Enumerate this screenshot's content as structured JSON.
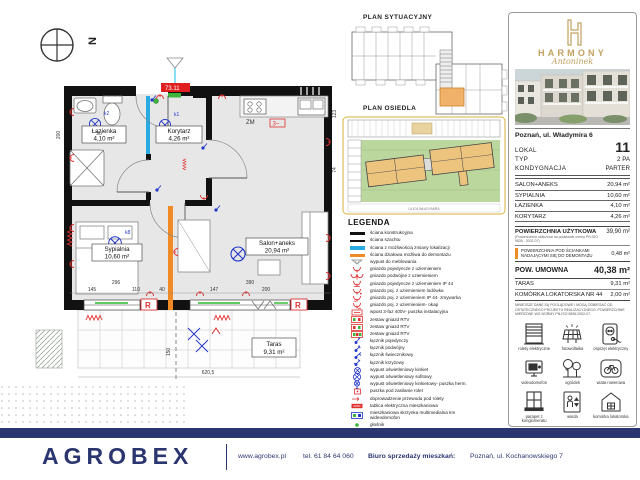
{
  "floorplan": {
    "north": "N",
    "entrance_no": "73.11",
    "zm": "ZM",
    "phase": "3~",
    "r_label": "R",
    "rooms": [
      {
        "name": "Łazienka",
        "area": "4,10 m²"
      },
      {
        "name": "Korytarz",
        "area": "4,26 m²"
      },
      {
        "name": "Sypialnia",
        "area": "10,60 m²"
      },
      {
        "name": "Salon+aneks",
        "area": "20,94 m²"
      },
      {
        "name": "Taras",
        "area": "9,31 m²"
      }
    ],
    "lights": [
      "k1",
      "k2",
      "k7",
      "k8"
    ],
    "dims": {
      "d1": "200",
      "d2": "90",
      "d3": "296",
      "d4": "390",
      "d5": "145",
      "d6": "110",
      "d7": "40",
      "d8": "147",
      "d9": "200",
      "d10": "620,5",
      "d11": "150",
      "d12": "74",
      "d13": "123"
    }
  },
  "plans": {
    "situational_title": "PLAN SYTUACYJNY",
    "estate_title": "PLAN OSIEDLA",
    "street_label": "ULICA WŁADYMIRA"
  },
  "legend": {
    "title": "LEGENDA",
    "items": [
      "ściana konstrukcyjna",
      "ściana szachtu",
      "ściana z możliwością zmiany lokalizacji",
      "ściana działowa możliwa do demontażu",
      "wypust do meblowania",
      "gniazdo pojedyncze z uziemieniem",
      "gniazdo podwójne z uziemieniem",
      "gniazdo pojedyncze z uziemieniem IP 44",
      "gniazdo poj. z uziemieniem lodówka",
      "gniazdo poj. z uziemieniem IP 44- zmywarka",
      "gniazdo poj. z uziemieniem- okap",
      "wpust 3-faz 400V- puszka instalacyjna",
      "zestaw gniazd RTV",
      "zestaw gniazd RTV",
      "zestaw gniazd RTV",
      "łącznik pojedynczy",
      "łącznik podwójny",
      "łącznik świecznikowy",
      "łącznik krzyżowy",
      "wypust oświetleniowy kinkiet",
      "wypust oświetleniowy sufitowy",
      "wypust oświetleniowy kinkietowy- puszka herm.",
      "puszka pod zasilanie rolet",
      "doprowadzenie przewodu pod rolety",
      "tablica elektryczna mieszkaniowa",
      "mieszkaniowa skrzynka multimedialna km wideodomofon",
      "głośnik",
      "nawiewnik ścienny"
    ]
  },
  "card": {
    "brand": {
      "name": "HARMONY",
      "script": "Antoninek"
    },
    "address": "Poznań, ul. Władymira 6",
    "lokal": {
      "label": "LOKAL",
      "value": "11"
    },
    "typ": {
      "label": "TYP",
      "value": "2 PA"
    },
    "kondygnacja": {
      "label": "KONDYGNACJA",
      "value": "PARTER"
    },
    "areas": [
      {
        "label": "SALON+ANEKS",
        "value": "20,94 m²"
      },
      {
        "label": "SYPIALNIA",
        "value": "10,60 m²"
      },
      {
        "label": "ŁAZIENKA",
        "value": "4,10 m²"
      },
      {
        "label": "KORYTARZ",
        "value": "4,26 m²"
      }
    ],
    "usable": {
      "label": "POWIERZCHNIA UŻYTKOWA",
      "note": "(Powierzchnia obliczona na podstawie normy PN-ISO 9836 : 2002-07)",
      "value": "39,90 m²"
    },
    "demontaz": {
      "label": "POWIERZCHNIA POD ŚCIANKAMI NADAJĄCYMI SIĘ DO DEMONTAŻU",
      "value": "0,48 m²"
    },
    "umowna": {
      "label": "POW. UMOWNA",
      "value": "40,38 m²"
    },
    "taras": {
      "label": "TARAS",
      "value": "9,31 m²"
    },
    "komorka": {
      "label": "KOMÓRKA LOKATORSKA  NR 44",
      "value": "2,00 m²"
    },
    "disclaimer": "NINIEJSZE DANE SĄ POGLĄDOWE I MOGĄ ODBIEGAĆ OD OSTATECZNEGO PROJEKTU REALIZACYJNEGO. POWIERZCHNIE MIERZONE WG NORMY PN-ISO 9836:2002-07.",
    "features": [
      "rolety elektryczne",
      "fotowoltaika",
      "osprzęt elektryczny",
      "videodomofon",
      "ogródek",
      "wiata rowerowa",
      "parapet z konglomeratu",
      "winda",
      "komórka lokatorska"
    ]
  },
  "footer": {
    "logo": "AGROBEX",
    "website": "www.agrobex.pl",
    "phone": "tel. 61 84 64 060",
    "office_label": "Biuro sprzedaży mieszkań:",
    "office_address": "Poznań, ul. Kochanowskiego 7"
  },
  "colors": {
    "navy": "#2b3670",
    "gold": "#c2a15f",
    "wall_blue": "#29abe2",
    "wall_orange": "#f08a24",
    "electric_red": "#e03131",
    "electric_blue": "#2336c9",
    "site_green": "#bcd79e",
    "building_tan": "#ecc47e"
  }
}
